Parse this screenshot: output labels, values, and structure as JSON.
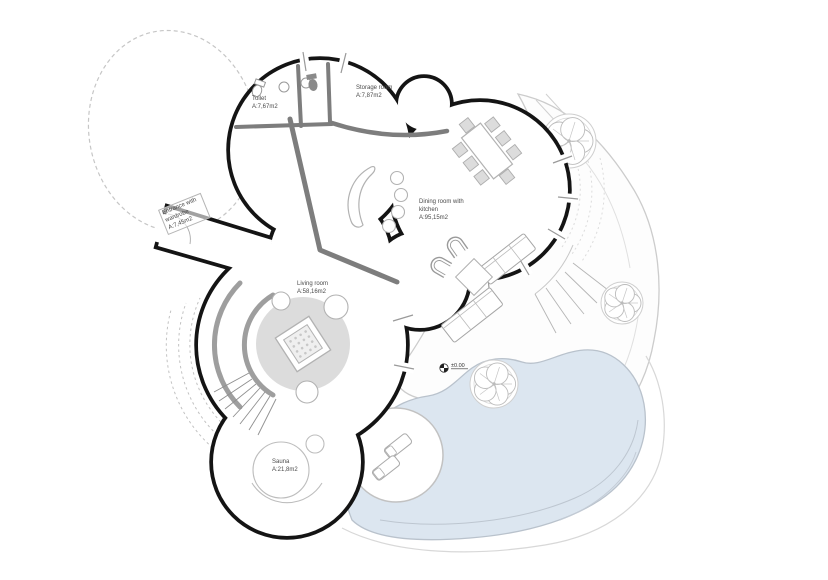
{
  "page": {
    "background": "#ffffff",
    "kind": "architectural floor plan"
  },
  "plan": {
    "rooms": {
      "toilet": {
        "name": "Toilet",
        "area": "A:7,67m2"
      },
      "storage": {
        "name": "Storage room",
        "area": "A:7,87m2"
      },
      "dining": {
        "name": "Dining room with kitchen",
        "area": "A:95,15m2"
      },
      "living": {
        "name": "Living room",
        "area": "A:58,16m2"
      },
      "sauna": {
        "name": "Sauna",
        "area": "A:21,8m2"
      },
      "entrance": {
        "name": "Entrance with wardrobe",
        "area": "A:7,45m2"
      }
    },
    "level_marker": {
      "value": "±0.00"
    },
    "colors": {
      "wall": "#141414",
      "interior_wall": "#7d7d7d",
      "pool_fill": "#dce6f0",
      "pool_edge": "#b9c2cc",
      "terrace_edge": "#cccccc",
      "rug_fill": "#dcdcdc",
      "furniture_line": "#b2b2b2",
      "label_text": "#4a4a4a"
    },
    "features": {
      "site_boundary": "dashed-circle",
      "terrace": "garden-terrace",
      "pool": "swimming-pool",
      "deck": "round-deck",
      "loungers": [
        "sun-lounger",
        "sun-lounger"
      ],
      "trees": [
        "tree",
        "tree",
        "tree"
      ],
      "stairs": [
        "curved-stair-left",
        "terrace-steps-right"
      ],
      "fire_pit": "square-fire-pit",
      "kitchen": "crescent-counter"
    }
  }
}
